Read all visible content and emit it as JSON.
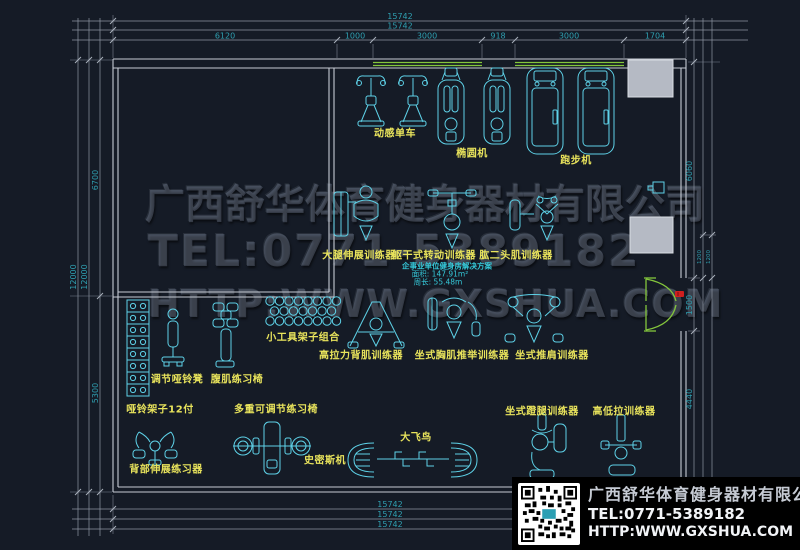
{
  "watermark": {
    "company": "广西舒华体育健身器材有限公司",
    "tel": "TEL:0771-5389182",
    "url": "HTTP:WWW.GXSHUA.COM"
  },
  "info_panel": {
    "company": "广西舒华体育健身器材有限公司",
    "tel": "TEL:0771-5389182",
    "url": "HTTP:WWW.GXSHUA.COM",
    "qr_icon": "qr-code"
  },
  "plan_note": {
    "title": "企事业单位健身房解决方案",
    "area": "面积: 147.91m²",
    "perimeter": "周长: 55.48m"
  },
  "labels": {
    "spin_bike": "动感单车",
    "elliptical": "椭圆机",
    "treadmill": "跑步机",
    "leg_extension": "大腿伸展训练器",
    "torso_rotation": "躯干式转动训练器",
    "biceps": "肱二头肌训练器",
    "tool_rack": "小工具架子组合",
    "adj_bench": "调节哑铃凳",
    "ab_chair": "腹肌练习椅",
    "dumbbell_rack": "哑铃架子12付",
    "multi_bench": "多重可调节练习椅",
    "lat_pull": "高拉力背肌训练器",
    "chest_press": "坐式胸肌推举训练器",
    "shoulder_press": "坐式推肩训练器",
    "back_ext": "背部伸展练习器",
    "smith": "史密斯机",
    "crossover": "大飞鸟",
    "leg_press": "坐式蹬腿训练器",
    "hi_lo": "高低拉训练器"
  },
  "dims": {
    "top_total_1": "15742",
    "top_total_2": "15742",
    "top_seg": [
      "6120",
      "1000",
      "3000",
      "918",
      "3000",
      "1704"
    ],
    "left_total_1": "12000",
    "left_total_2": "12000",
    "left_seg": [
      "6700",
      "5300"
    ],
    "right_seg": [
      "6060",
      "1500",
      "4440"
    ],
    "right_small": [
      "1200",
      "1200"
    ],
    "bottom": [
      "15742",
      "15742",
      "15742"
    ]
  },
  "colors": {
    "background": "#151b26",
    "equipment": "#5ed2e8",
    "labels": "#e9e45c",
    "dimensions": "#2f9fb0",
    "walls": "#c6cbd4",
    "windows_doors": "#84c63c",
    "door_tag": "#cf1f1f"
  }
}
